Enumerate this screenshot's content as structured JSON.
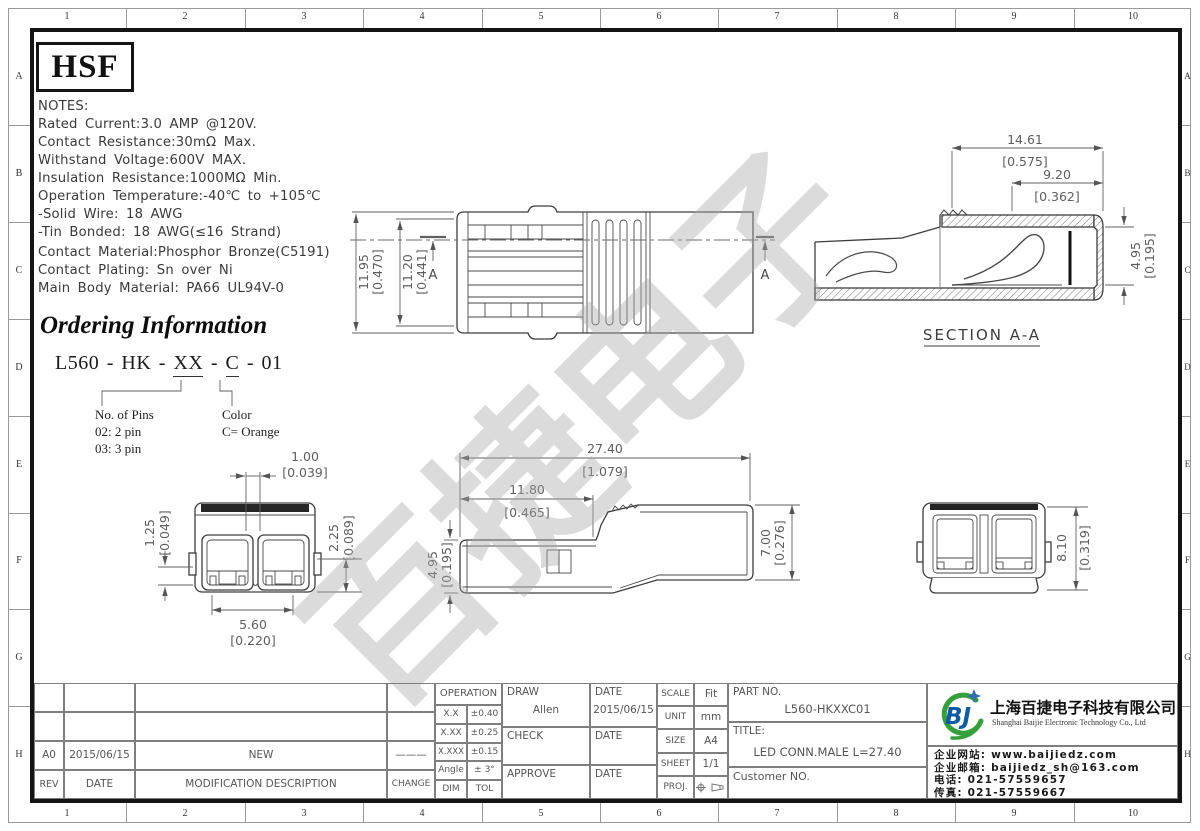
{
  "border": {
    "cols": [
      "1",
      "2",
      "3",
      "4",
      "5",
      "6",
      "7",
      "8",
      "9",
      "10"
    ],
    "rows": [
      "A",
      "B",
      "C",
      "D",
      "E",
      "F",
      "G",
      "H"
    ]
  },
  "brand": {
    "logo": "HSF"
  },
  "notes": {
    "lines": [
      "NOTES:",
      "Rated Current:3.0 AMP @120V.",
      "Contact Resistance:30mΩ Max.",
      "Withstand Voltage:600V MAX.",
      "Insulation Resistance:1000MΩ Min.",
      "Operation Temperature:-40℃ to +105℃",
      "-Solid Wire: 18 AWG",
      "-Tin Bonded: 18 AWG(≤16 Strand)"
    ],
    "materials": [
      "Contact Material:Phosphor Bronze(C5191)",
      "Contact Plating: Sn over Ni",
      "Main Body Material: PA66 UL94V-0"
    ]
  },
  "ordering": {
    "title": "Ordering Information",
    "code_parts": {
      "p1": "L560 - HK - ",
      "p2": "XX",
      "p3": " - ",
      "p4": "C",
      "p5": " - 01"
    },
    "pins_label": "No. of Pins",
    "pins_opt1": "02: 2 pin",
    "pins_opt2": "03: 3 pin",
    "color_label": "Color",
    "color_opt": "C= Orange"
  },
  "watermark": {
    "text": "百捷电子"
  },
  "drawings": {
    "top_view": {
      "dim1_mm": "11.95",
      "dim1_in": "[0.470]",
      "dim2_mm": "11.20",
      "dim2_in": "[0.441]",
      "section_mark": "A"
    },
    "section": {
      "title": "SECTION A-A",
      "dim1_mm": "14.61",
      "dim1_in": "[0.575]",
      "dim2_mm": "9.20",
      "dim2_in": "[0.362]",
      "dim3_mm": "4.95",
      "dim3_in": "[0.195]"
    },
    "front_view": {
      "dim1_mm": "1.00",
      "dim1_in": "[0.039]",
      "dim2_mm": "1.25",
      "dim2_in": "[0.049]",
      "dim3_mm": "2.25",
      "dim3_in": "[0.089]",
      "dim4_mm": "5.60",
      "dim4_in": "[0.220]"
    },
    "side_view": {
      "dim1_mm": "27.40",
      "dim1_in": "[1.079]",
      "dim2_mm": "11.80",
      "dim2_in": "[0.465]",
      "dim3_mm": "4.95",
      "dim3_in": "[0.195]",
      "dim4_mm": "7.00",
      "dim4_in": "[0.276]"
    },
    "rear_view": {
      "dim1_mm": "8.10",
      "dim1_in": "[0.319]"
    }
  },
  "revision": {
    "headers": {
      "rev": "REV",
      "date": "DATE",
      "desc": "MODIFICATION  DESCRIPTION",
      "change": "CHANGE"
    },
    "rows": [
      {
        "rev": "A0",
        "date": "2015/06/15",
        "desc": "NEW",
        "change": "———"
      }
    ]
  },
  "tolerance": {
    "header": "OPERATION",
    "rows": [
      [
        "X.X",
        "±0.40"
      ],
      [
        "X.XX",
        "±0.25"
      ],
      [
        "X.XXX",
        "±0.15"
      ],
      [
        "Angle",
        "± 3°"
      ],
      [
        "DIM",
        "TOL"
      ]
    ]
  },
  "sign": {
    "draw_label": "DRAW",
    "draw_name": "Allen",
    "date_label": "DATE",
    "draw_date": "2015/06/15",
    "check_label": "CHECK",
    "approve_label": "APPROVE"
  },
  "info": {
    "scale_label": "SCALE",
    "scale": "Fit",
    "unit_label": "UNIT",
    "unit": "mm",
    "size_label": "SIZE",
    "size": "A4",
    "sheet_label": "SHEET",
    "sheet": "1/1",
    "proj_label": "PROJ."
  },
  "part": {
    "part_no_label": "PART  NO.",
    "part_no": "L560-HKXXC01",
    "title_label": "TITLE:",
    "title": "LED  CONN.MALE  L=27.40",
    "customer_label": "Customer  NO."
  },
  "company": {
    "logo_text": "BJ",
    "name_cn": "上海百捷电子科技有限公司",
    "name_en": "Shanghai Baijie Electronic Technology Co., Ltd",
    "website_label": "企业网站:",
    "website": "www.baijiedz.com",
    "email_label": "企业邮箱:",
    "email": "baijiedz_sh@163.com",
    "phone_label": "电话:",
    "phone": "021-57559657",
    "fax_label": "传真:",
    "fax": "021-57559667"
  }
}
